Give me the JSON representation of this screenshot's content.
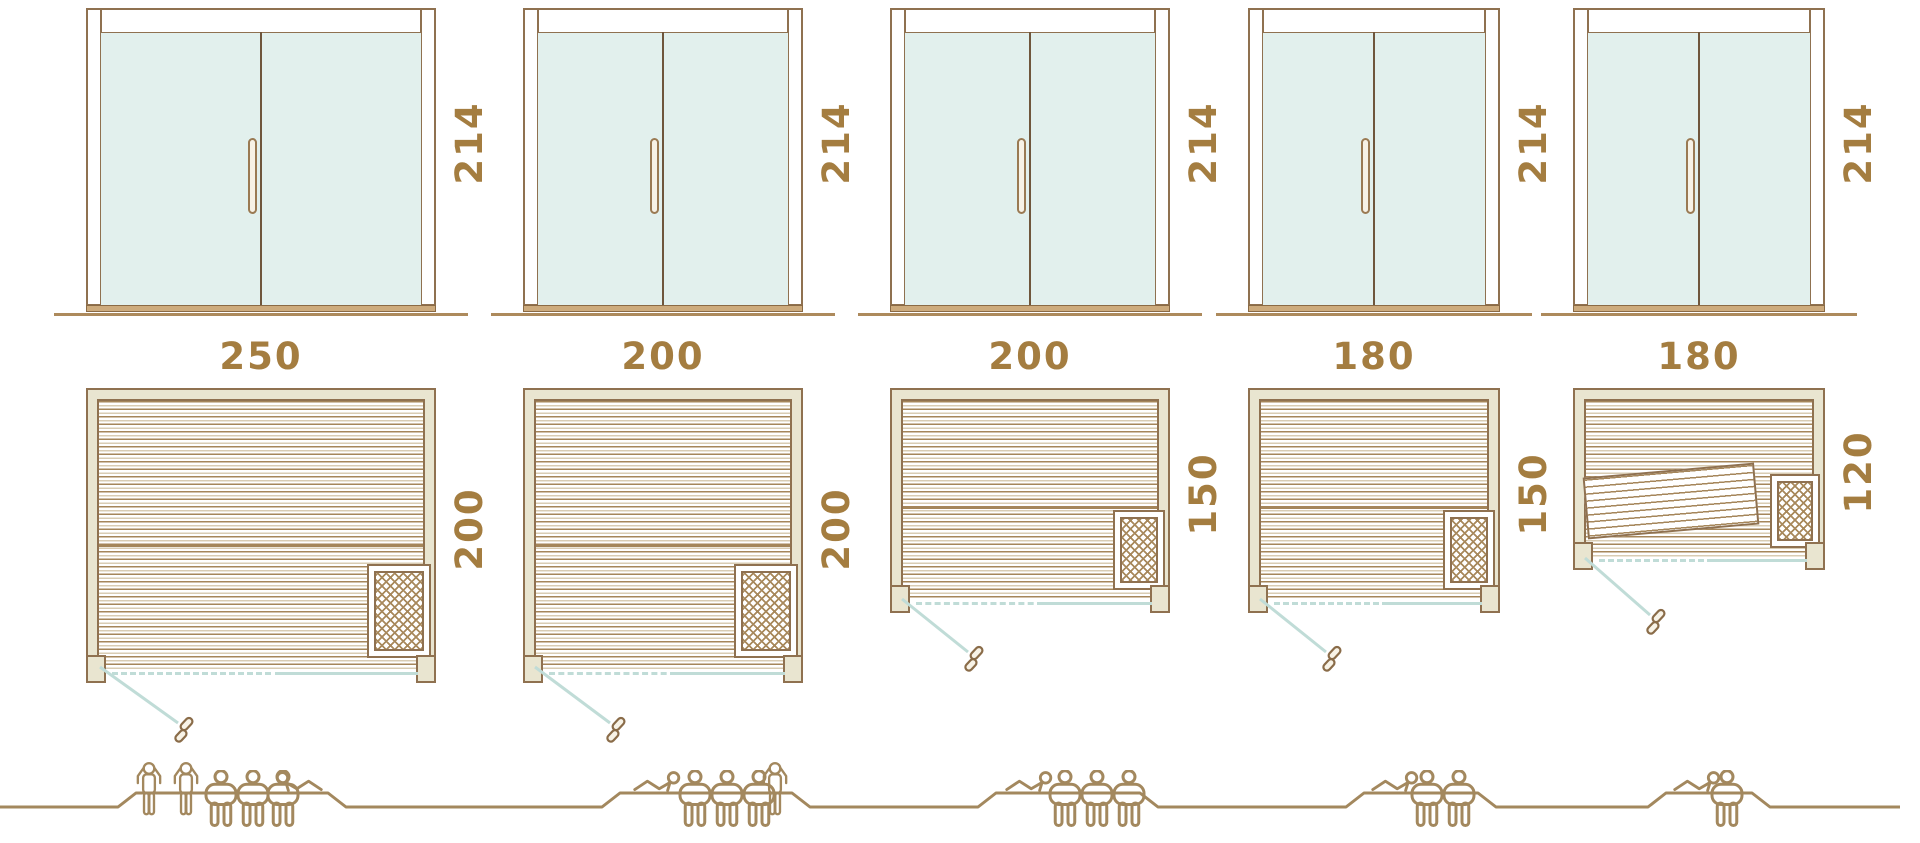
{
  "diagram_title": "Sauna cabin size comparison with door height, floor plan dimensions and capacity",
  "colors": {
    "line_brown": "#8f7150",
    "people_brown": "#a3885e",
    "label_brown": "#a47d40",
    "frame_beige": "#e9e5d0",
    "glass_mint": "#e2f0ed",
    "swing_teal": "#c0dcd7",
    "sill_tan": "#cdab7d"
  },
  "saunas": [
    {
      "id": "sauna-250x200",
      "door_height_label": "214",
      "width_label": "250",
      "depth_label": "200",
      "capacity": {
        "standing": 2,
        "seated": 3,
        "lying": 1,
        "total": 6
      },
      "figures": [
        "standing",
        "standing",
        "seated",
        "seated",
        "seated",
        "lying-right"
      ]
    },
    {
      "id": "sauna-200x200",
      "door_height_label": "214",
      "width_label": "200",
      "depth_label": "200",
      "capacity": {
        "standing": 1,
        "seated": 3,
        "lying": 1,
        "total": 5
      },
      "figures": [
        "lying",
        "seated",
        "seated",
        "seated",
        "standing"
      ]
    },
    {
      "id": "sauna-200x150",
      "door_height_label": "214",
      "width_label": "200",
      "depth_label": "150",
      "capacity": {
        "standing": 0,
        "seated": 3,
        "lying": 1,
        "total": 4
      },
      "figures": [
        "lying",
        "seated",
        "seated",
        "seated"
      ]
    },
    {
      "id": "sauna-180x150",
      "door_height_label": "214",
      "width_label": "180",
      "depth_label": "150",
      "capacity": {
        "standing": 0,
        "seated": 2,
        "lying": 1,
        "total": 3
      },
      "figures": [
        "lying",
        "seated",
        "seated"
      ]
    },
    {
      "id": "sauna-180x120",
      "door_height_label": "214",
      "width_label": "180",
      "depth_label": "120",
      "capacity": {
        "standing": 0,
        "seated": 1,
        "lying": 1,
        "total": 2
      },
      "figures": [
        "lying",
        "seated"
      ]
    }
  ]
}
